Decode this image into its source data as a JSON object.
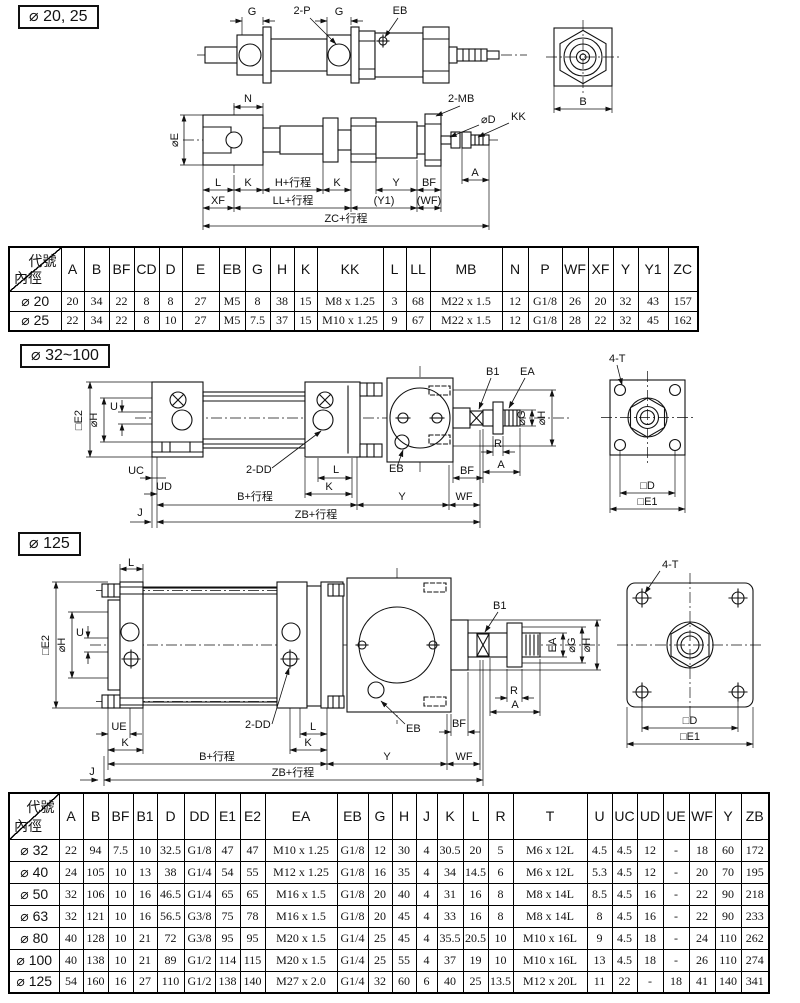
{
  "page": {
    "bg": "#ffffff",
    "ink": "#111111"
  },
  "sections": {
    "s1": {
      "title": "⌀ 20, 25"
    },
    "s2": {
      "title": "⌀ 32~100"
    },
    "s3": {
      "title": "⌀ 125"
    }
  },
  "drawings": {
    "d20_side1": {
      "g1": "G",
      "p": "2-P",
      "g2": "G",
      "eb": "EB"
    },
    "d20_end": {
      "b": "B"
    },
    "d20_side2": {
      "n": "N",
      "e": "⌀E",
      "mb": "2-MB",
      "d": "⌀D",
      "kk": "KK",
      "a": "A",
      "l": "L",
      "k1": "K",
      "h": "H+行程",
      "k2": "K",
      "y": "Y",
      "bf": "BF",
      "xf": "XF",
      "ll": "LL+行程",
      "y1": "(Y1)",
      "wf": "(WF)",
      "zc": "ZC+行程"
    },
    "d32": {
      "e2": "□E2",
      "h_left": "⌀H",
      "u": "U",
      "uc": "UC",
      "ud": "UD",
      "dd": "2-DD",
      "l": "L",
      "k": "K",
      "eb": "EB",
      "bf": "BF",
      "b1": "B1",
      "ea": "EA",
      "g": "⌀G",
      "h_right": "⌀H",
      "r": "R",
      "a": "A",
      "b": "B+行程",
      "y": "Y",
      "wf": "WF",
      "zb": "ZB+行程",
      "j": "J"
    },
    "d32_end": {
      "t": "4-T",
      "d": "□D",
      "e1": "□E1"
    },
    "d125": {
      "l_top": "L",
      "e2": "□E2",
      "h_left": "⌀H",
      "u": "U",
      "ue": "UE",
      "k1": "K",
      "dd": "2-DD",
      "l": "L",
      "k2": "K",
      "eb": "EB",
      "bf": "BF",
      "b1": "B1",
      "ea": "EA",
      "g": "⌀G",
      "h_right": "⌀H",
      "r": "R",
      "a": "A",
      "b": "B+行程",
      "y": "Y",
      "wf": "WF",
      "zb": "ZB+行程",
      "j": "J"
    },
    "d125_end": {
      "t": "4-T",
      "d": "□D",
      "e1": "□E1"
    }
  },
  "table1": {
    "corner_top": "代號",
    "corner_bottom": "內徑",
    "col_widths": [
      52,
      23,
      25,
      25,
      25,
      23,
      37,
      26,
      25,
      24,
      23,
      66,
      23,
      24,
      72,
      26,
      34,
      26,
      25,
      25,
      30,
      30
    ],
    "headers": [
      "A",
      "B",
      "BF",
      "CD",
      "D",
      "E",
      "EB",
      "G",
      "H",
      "K",
      "KK",
      "L",
      "LL",
      "MB",
      "N",
      "P",
      "WF",
      "XF",
      "Y",
      "Y1",
      "ZC"
    ],
    "rows": [
      {
        "label": "⌀ 20",
        "values": [
          "20",
          "34",
          "22",
          "8",
          "8",
          "27",
          "M5",
          "8",
          "38",
          "15",
          "M8 x 1.25",
          "3",
          "68",
          "M22 x 1.5",
          "12",
          "G1/8",
          "26",
          "20",
          "32",
          "43",
          "157"
        ]
      },
      {
        "label": "⌀ 25",
        "values": [
          "22",
          "34",
          "22",
          "8",
          "10",
          "27",
          "M5",
          "7.5",
          "37",
          "15",
          "M10 x 1.25",
          "9",
          "67",
          "M22 x 1.5",
          "12",
          "G1/8",
          "28",
          "22",
          "32",
          "45",
          "162"
        ]
      }
    ]
  },
  "table2": {
    "corner_top": "代號",
    "corner_bottom": "內徑",
    "col_widths": [
      50,
      24,
      25,
      25,
      24,
      27,
      31,
      25,
      25,
      72,
      31,
      24,
      24,
      21,
      26,
      25,
      25,
      74,
      25,
      25,
      26,
      26,
      26,
      26,
      28
    ],
    "headers": [
      "A",
      "B",
      "BF",
      "B1",
      "D",
      "DD",
      "E1",
      "E2",
      "EA",
      "EB",
      "G",
      "H",
      "J",
      "K",
      "L",
      "R",
      "T",
      "U",
      "UC",
      "UD",
      "UE",
      "WF",
      "Y",
      "ZB"
    ],
    "rows": [
      {
        "label": "⌀ 32",
        "values": [
          "22",
          "94",
          "7.5",
          "10",
          "32.5",
          "G1/8",
          "47",
          "47",
          "M10 x 1.25",
          "G1/8",
          "12",
          "30",
          "4",
          "30.5",
          "20",
          "5",
          "M6 x 12L",
          "4.5",
          "4.5",
          "12",
          "-",
          "18",
          "60",
          "172"
        ]
      },
      {
        "label": "⌀ 40",
        "values": [
          "24",
          "105",
          "10",
          "13",
          "38",
          "G1/4",
          "54",
          "55",
          "M12 x 1.25",
          "G1/8",
          "16",
          "35",
          "4",
          "34",
          "14.5",
          "6",
          "M6 x 12L",
          "5.3",
          "4.5",
          "12",
          "-",
          "20",
          "70",
          "195"
        ]
      },
      {
        "label": "⌀ 50",
        "values": [
          "32",
          "106",
          "10",
          "16",
          "46.5",
          "G1/4",
          "65",
          "65",
          "M16 x 1.5",
          "G1/8",
          "20",
          "40",
          "4",
          "31",
          "16",
          "8",
          "M8 x 14L",
          "8.5",
          "4.5",
          "16",
          "-",
          "22",
          "90",
          "218"
        ]
      },
      {
        "label": "⌀ 63",
        "values": [
          "32",
          "121",
          "10",
          "16",
          "56.5",
          "G3/8",
          "75",
          "78",
          "M16 x 1.5",
          "G1/8",
          "20",
          "45",
          "4",
          "33",
          "16",
          "8",
          "M8 x 14L",
          "8",
          "4.5",
          "16",
          "-",
          "22",
          "90",
          "233"
        ]
      },
      {
        "label": "⌀ 80",
        "values": [
          "40",
          "128",
          "10",
          "21",
          "72",
          "G3/8",
          "95",
          "95",
          "M20 x 1.5",
          "G1/4",
          "25",
          "45",
          "4",
          "35.5",
          "20.5",
          "10",
          "M10 x 16L",
          "9",
          "4.5",
          "18",
          "-",
          "24",
          "110",
          "262"
        ]
      },
      {
        "label": "⌀ 100",
        "values": [
          "40",
          "138",
          "10",
          "21",
          "89",
          "G1/2",
          "114",
          "115",
          "M20 x 1.5",
          "G1/4",
          "25",
          "55",
          "4",
          "37",
          "19",
          "10",
          "M10 x 16L",
          "13",
          "4.5",
          "18",
          "-",
          "26",
          "110",
          "274"
        ]
      },
      {
        "label": "⌀ 125",
        "values": [
          "54",
          "160",
          "16",
          "27",
          "110",
          "G1/2",
          "138",
          "140",
          "M27 x 2.0",
          "G1/4",
          "32",
          "60",
          "6",
          "40",
          "25",
          "13.5",
          "M12 x 20L",
          "11",
          "22",
          "-",
          "18",
          "41",
          "140",
          "341"
        ]
      }
    ]
  }
}
